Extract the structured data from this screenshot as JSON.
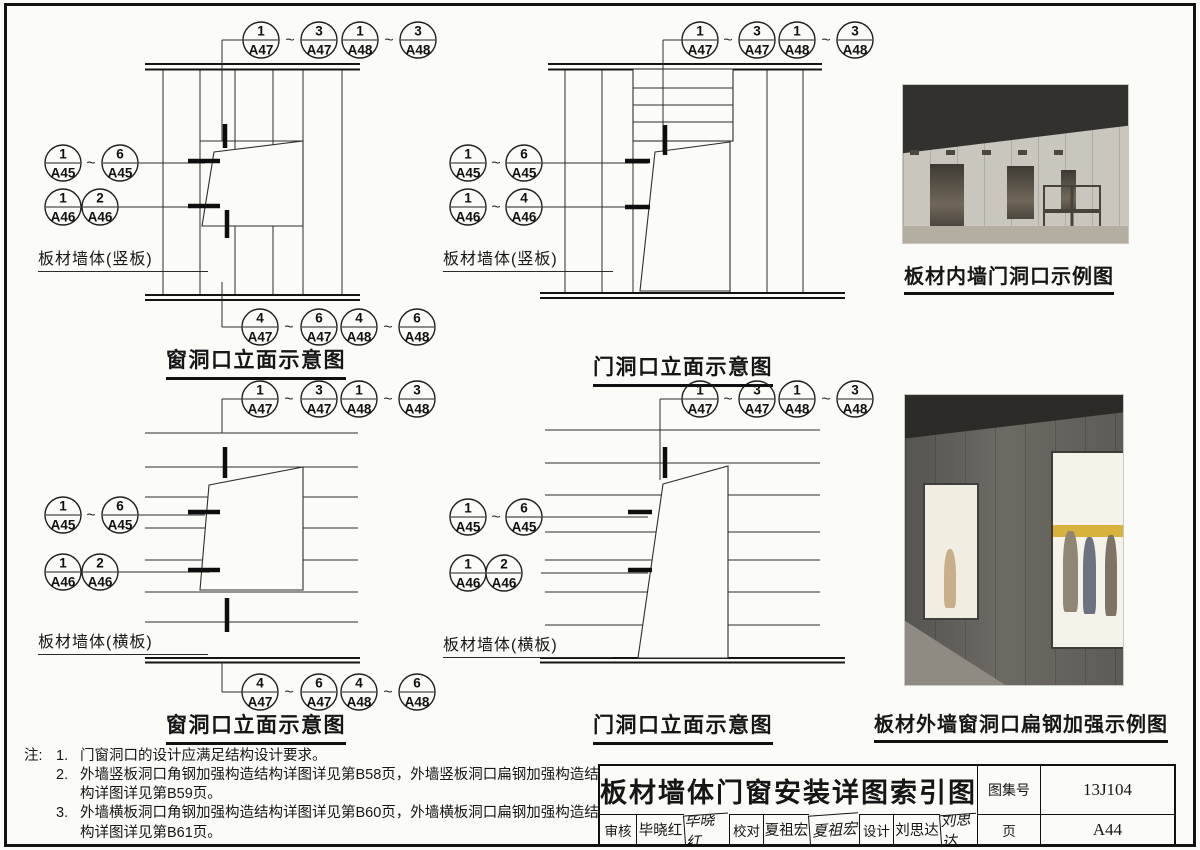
{
  "diagrams": [
    {
      "id": "window-opening-vertical-panel",
      "title": "窗洞口立面示意图",
      "wall_label": "板材墙体(竖板)",
      "callouts": {
        "top": [
          [
            "1",
            "A47"
          ],
          [
            "3",
            "A47"
          ],
          [
            "1",
            "A48"
          ],
          [
            "3",
            "A48"
          ]
        ],
        "left": [
          [
            "1",
            "A45"
          ],
          [
            "6",
            "A45"
          ],
          [
            "1",
            "A46"
          ],
          [
            "2",
            "A46"
          ]
        ],
        "bottom": [
          [
            "4",
            "A47"
          ],
          [
            "6",
            "A47"
          ],
          [
            "4",
            "A48"
          ],
          [
            "6",
            "A48"
          ]
        ]
      }
    },
    {
      "id": "door-opening-vertical-panel",
      "title": "门洞口立面示意图",
      "wall_label": "板材墙体(竖板)",
      "callouts": {
        "top": [
          [
            "1",
            "A47"
          ],
          [
            "3",
            "A47"
          ],
          [
            "1",
            "A48"
          ],
          [
            "3",
            "A48"
          ]
        ],
        "left": [
          [
            "1",
            "A45"
          ],
          [
            "6",
            "A45"
          ],
          [
            "1",
            "A46"
          ],
          [
            "4",
            "A46"
          ]
        ]
      }
    },
    {
      "id": "window-opening-horizontal-panel",
      "title": "窗洞口立面示意图",
      "wall_label": "板材墙体(横板)",
      "callouts": {
        "top": [
          [
            "1",
            "A47"
          ],
          [
            "3",
            "A47"
          ],
          [
            "1",
            "A48"
          ],
          [
            "3",
            "A48"
          ]
        ],
        "left": [
          [
            "1",
            "A45"
          ],
          [
            "6",
            "A45"
          ],
          [
            "1",
            "A46"
          ],
          [
            "2",
            "A46"
          ]
        ],
        "bottom": [
          [
            "4",
            "A47"
          ],
          [
            "6",
            "A47"
          ],
          [
            "4",
            "A48"
          ],
          [
            "6",
            "A48"
          ]
        ]
      }
    },
    {
      "id": "door-opening-horizontal-panel",
      "title": "门洞口立面示意图",
      "wall_label": "板材墙体(横板)",
      "callouts": {
        "top": [
          [
            "1",
            "A47"
          ],
          [
            "3",
            "A47"
          ],
          [
            "1",
            "A48"
          ],
          [
            "3",
            "A48"
          ]
        ],
        "left": [
          [
            "1",
            "A45"
          ],
          [
            "6",
            "A45"
          ],
          [
            "1",
            "A46"
          ],
          [
            "2",
            "A46"
          ]
        ]
      }
    }
  ],
  "photos": [
    {
      "caption": "板材内墙门洞口示例图"
    },
    {
      "caption": "板材外墙窗洞口扁钢加强示例图"
    }
  ],
  "notes": {
    "label": "注:",
    "items": [
      {
        "no": "1.",
        "text": "门窗洞口的设计应满足结构设计要求。"
      },
      {
        "no": "2.",
        "text": "外墙竖板洞口角钢加强构造结构详图详见第B58页，外墙竖板洞口扁钢加强构造结构详图详见第B59页。"
      },
      {
        "no": "3.",
        "text": "外墙横板洞口角钢加强构造结构详图详见第B60页，外墙横板洞口扁钢加强构造结构详图详见第B61页。"
      }
    ]
  },
  "titleblock": {
    "title": "板材墙体门窗安装详图索引图",
    "atlas_label": "图集号",
    "atlas_no": "13J104",
    "page_label": "页",
    "page_no": "A44",
    "reviewer_label": "审核",
    "reviewer": "毕晓红",
    "reviewer_sig": "毕晓红",
    "checker_label": "校对",
    "checker": "夏祖宏",
    "checker_sig": "夏祖宏",
    "designer_label": "设计",
    "designer": "刘思达",
    "designer_sig": "刘思达"
  }
}
